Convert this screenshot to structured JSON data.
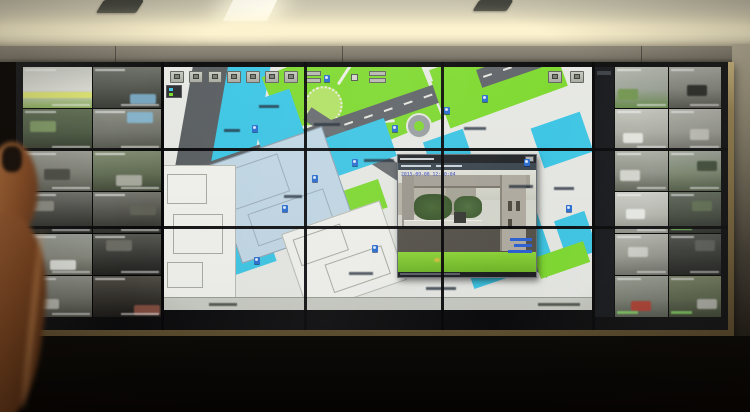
{
  "scene": {
    "setting": "photograph of a security control room video wall",
    "wall_panel_columns": 5,
    "wall_panel_rows": 3,
    "foreground": "out-of-focus arm and hand at lower left"
  },
  "colors": {
    "map_background": "#e9ebe7",
    "map_building_cyan": "#3cc8e8",
    "map_building_pale": "#c3d9e8",
    "map_lawn_green": "#7fdc30",
    "map_road_gray": "#60656a",
    "popup_timestamp_blue": "#2b3fc0",
    "frame_gold": "#9c8756",
    "ceiling_cream": "#d3cdb6",
    "overlay_label_green": "#82e65a"
  },
  "map": {
    "toolbar_button_count": 7,
    "has_pan_dpad": true,
    "has_status_bar": true,
    "labels": [
      {
        "x": 95,
        "y": 38,
        "w": 20
      },
      {
        "x": 150,
        "y": 56,
        "w": 26
      },
      {
        "x": 200,
        "y": 92,
        "w": 30
      },
      {
        "x": 120,
        "y": 128,
        "w": 18
      },
      {
        "x": 300,
        "y": 60,
        "w": 22
      },
      {
        "x": 345,
        "y": 118,
        "w": 24
      },
      {
        "x": 60,
        "y": 62,
        "w": 16
      },
      {
        "x": 185,
        "y": 205,
        "w": 24
      },
      {
        "x": 262,
        "y": 220,
        "w": 30
      },
      {
        "x": 390,
        "y": 120,
        "w": 20
      }
    ],
    "camera_icons": [
      {
        "x": 148,
        "y": 108
      },
      {
        "x": 188,
        "y": 92
      },
      {
        "x": 228,
        "y": 58
      },
      {
        "x": 118,
        "y": 138
      },
      {
        "x": 208,
        "y": 178
      },
      {
        "x": 88,
        "y": 58
      },
      {
        "x": 318,
        "y": 28
      },
      {
        "x": 360,
        "y": 92
      },
      {
        "x": 402,
        "y": 138
      },
      {
        "x": 90,
        "y": 190
      },
      {
        "x": 280,
        "y": 40
      },
      {
        "x": 160,
        "y": 8
      }
    ]
  },
  "popup": {
    "timestamp": "2015-09-08 12:50:04",
    "camera_label_lines": 3,
    "close_glyph": ""
  },
  "left_tiles": [
    {
      "top": "#cfd3c9",
      "mid": "#e6e7de",
      "bot": "#86b34a",
      "band": "#e8f060",
      "bandy": 62,
      "acc": null,
      "label": "white"
    },
    {
      "top": "#6a6f66",
      "mid": "#4a4f46",
      "bot": "#2e3129",
      "band": null,
      "acc": "#6fa8c8",
      "ax": 55,
      "ay": 65,
      "label": "white"
    },
    {
      "top": "#5a6b4a",
      "mid": "#45563a",
      "bot": "#2c3524",
      "band": null,
      "acc": "#7a9a5a",
      "ax": 10,
      "ay": 30,
      "label": "white"
    },
    {
      "top": "#8a8d82",
      "mid": "#6f7268",
      "bot": "#4c4f44",
      "band": null,
      "acc": "#7fb7d4",
      "ax": 50,
      "ay": 8,
      "label": "white"
    },
    {
      "top": "#9a9c92",
      "mid": "#7c7e72",
      "bot": "#565a4e",
      "band": null,
      "acc": "#44463c",
      "ax": 30,
      "ay": 45,
      "label": "white"
    },
    {
      "top": "#7c8a6a",
      "mid": "#5e6c4e",
      "bot": "#3b4430",
      "band": null,
      "acc": "#a9ab9f",
      "ax": 35,
      "ay": 60,
      "label": "white"
    },
    {
      "top": "#6e6f68",
      "mid": "#3f403a",
      "bot": "#1d1e1a",
      "band": null,
      "acc": "#8a8c80",
      "ax": 8,
      "ay": 20,
      "label": "white"
    },
    {
      "top": "#75766e",
      "mid": "#4a4b43",
      "bot": "#262722",
      "band": null,
      "acc": "#5e6054",
      "ax": 55,
      "ay": 30,
      "label": "white"
    },
    {
      "top": "#9aa096",
      "mid": "#8a8c80",
      "bot": "#5e6054",
      "band": null,
      "acc": "#e8eae4",
      "ax": 40,
      "ay": 62,
      "label": "white"
    },
    {
      "top": "#55564e",
      "mid": "#333430",
      "bot": "#191a17",
      "band": null,
      "acc": "#6a6b62",
      "ax": 20,
      "ay": 15,
      "label": "white"
    },
    {
      "top": "#8f9288",
      "mid": "#6e7166",
      "bot": "#44463c",
      "band": null,
      "acc": "#b9bbb1",
      "ax": 15,
      "ay": 55,
      "label": "white"
    },
    {
      "top": "#4e4a42",
      "mid": "#2f2c26",
      "bot": "#171512",
      "band": null,
      "acc": "#8a4a3a",
      "ax": 60,
      "ay": 70,
      "label": "white"
    }
  ],
  "right_tiles": [
    {
      "top": "#b9bdb2",
      "mid": "#9fa79a",
      "bot": "#5f8a3f",
      "band": null,
      "acc": "#6e9a46",
      "ax": 5,
      "ay": 55,
      "label": "white"
    },
    {
      "top": "#a8aca2",
      "mid": "#83867c",
      "bot": "#4e5046",
      "band": null,
      "acc": "#20221e",
      "ax": 35,
      "ay": 45,
      "label": "white"
    },
    {
      "top": "#c9cbc2",
      "mid": "#b0b2a8",
      "bot": "#8b8d82",
      "band": null,
      "acc": "#e9ebe5",
      "ax": 15,
      "ay": 58,
      "label": "white"
    },
    {
      "top": "#b4b6ac",
      "mid": "#9b9d92",
      "bot": "#6e7066",
      "band": null,
      "acc": "#c6c8be",
      "ax": 40,
      "ay": 50,
      "label": "white"
    },
    {
      "top": "#aeb2a6",
      "mid": "#8f9386",
      "bot": "#5c6152",
      "band": null,
      "acc": "#dadcd4",
      "ax": 10,
      "ay": 48,
      "label": "white"
    },
    {
      "top": "#9fa89a",
      "mid": "#7c8a6e",
      "bot": "#4c5a40",
      "band": null,
      "acc": "#3a4a30",
      "ax": 55,
      "ay": 25,
      "label": "white"
    },
    {
      "top": "#d2d4cc",
      "mid": "#bbbdb4",
      "bot": "#8f9188",
      "band": null,
      "acc": "#f0f2ec",
      "ax": 20,
      "ay": 40,
      "label": "white"
    },
    {
      "top": "#5e6858",
      "mid": "#414a3c",
      "bot": "#232822",
      "band": null,
      "acc": "#60724e",
      "ax": 45,
      "ay": 20,
      "label": "green"
    },
    {
      "top": "#b8bab0",
      "mid": "#9a9c92",
      "bot": "#6f7168",
      "band": null,
      "acc": "#d5d7cf",
      "ax": 25,
      "ay": 30,
      "label": "white"
    },
    {
      "top": "#4a4e48",
      "mid": "#30332e",
      "bot": "#181a17",
      "band": null,
      "acc": "#5c605a",
      "ax": 50,
      "ay": 15,
      "label": "white"
    },
    {
      "top": "#9aa092",
      "mid": "#7e8476",
      "bot": "#545a4c",
      "band": null,
      "acc": "#c23a2a",
      "ax": 30,
      "ay": 60,
      "label": "green"
    },
    {
      "top": "#76825e",
      "mid": "#5a6848",
      "bot": "#38422c",
      "band": null,
      "acc": "#b9bbb1",
      "ax": 55,
      "ay": 55,
      "label": "green"
    }
  ]
}
